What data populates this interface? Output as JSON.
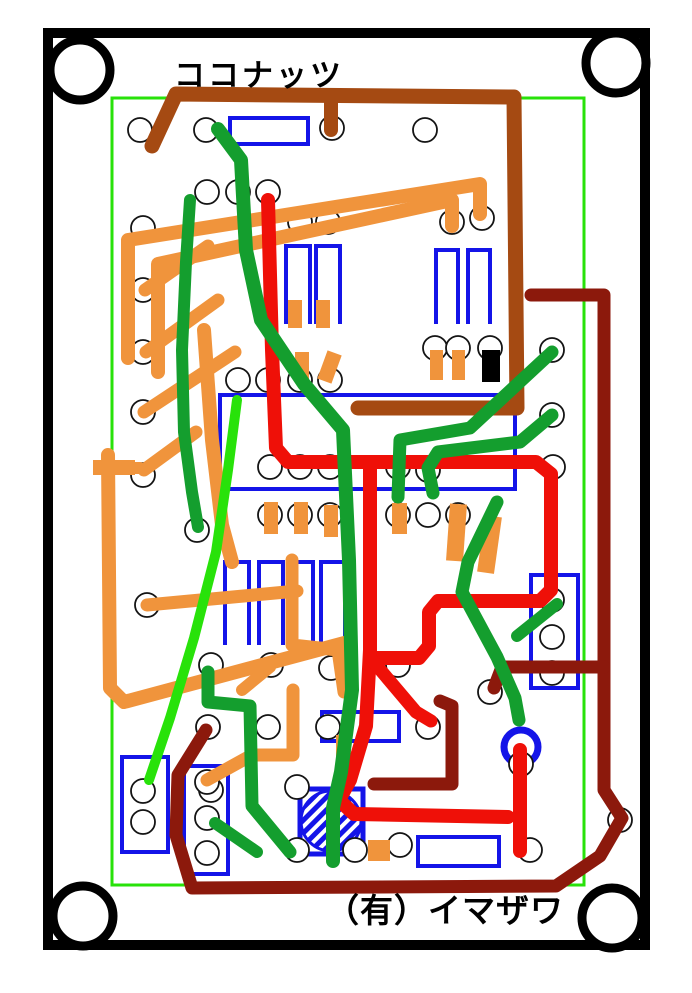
{
  "title": "ココナッツ",
  "footer": "（有）イマザワ",
  "colors": {
    "black": "#000000",
    "blue": "#1414E8",
    "orange": "#F0943C",
    "brown": "#A54A12",
    "maroon": "#8C190C",
    "red": "#EF1008",
    "green": "#149E2E",
    "bright": "#28E20A",
    "hole_stroke": "#141414",
    "white": "#ffffff"
  },
  "board": {
    "frame": {
      "x": 48,
      "y": 33,
      "w": 597,
      "h": 912,
      "stroke_w": 10
    },
    "green_border": {
      "x": 112,
      "y": 98,
      "w": 472,
      "h": 787,
      "stroke_w": 3
    },
    "corner_holes": {
      "r": 30,
      "stroke_w": 9,
      "centers": [
        [
          80,
          70
        ],
        [
          616,
          63
        ],
        [
          83,
          916
        ],
        [
          612,
          918
        ]
      ]
    },
    "hole_r": 12,
    "holes": [
      [
        140,
        130
      ],
      [
        206,
        130
      ],
      [
        332,
        128
      ],
      [
        425,
        130
      ],
      [
        207,
        192
      ],
      [
        238,
        192
      ],
      [
        268,
        192
      ],
      [
        143,
        228
      ],
      [
        300,
        222
      ],
      [
        328,
        222
      ],
      [
        452,
        222
      ],
      [
        482,
        218
      ],
      [
        143,
        290
      ],
      [
        143,
        352
      ],
      [
        143,
        412
      ],
      [
        143,
        475
      ],
      [
        238,
        380
      ],
      [
        268,
        380
      ],
      [
        300,
        380
      ],
      [
        330,
        380
      ],
      [
        435,
        348
      ],
      [
        458,
        348
      ],
      [
        490,
        348
      ],
      [
        552,
        350
      ],
      [
        552,
        415
      ],
      [
        553,
        467
      ],
      [
        270,
        467
      ],
      [
        300,
        467
      ],
      [
        330,
        467
      ],
      [
        398,
        467
      ],
      [
        428,
        470
      ],
      [
        270,
        515
      ],
      [
        300,
        515
      ],
      [
        330,
        515
      ],
      [
        398,
        515
      ],
      [
        428,
        515
      ],
      [
        458,
        515
      ],
      [
        197,
        530
      ],
      [
        147,
        605
      ],
      [
        552,
        600
      ],
      [
        552,
        637
      ],
      [
        552,
        673
      ],
      [
        398,
        665
      ],
      [
        211,
        665
      ],
      [
        271,
        665
      ],
      [
        331,
        668
      ],
      [
        208,
        727
      ],
      [
        268,
        727
      ],
      [
        328,
        727
      ],
      [
        428,
        727
      ],
      [
        490,
        692
      ],
      [
        211,
        790
      ],
      [
        143,
        791
      ],
      [
        143,
        822
      ],
      [
        207,
        782
      ],
      [
        207,
        818
      ],
      [
        207,
        853
      ],
      [
        297,
        787
      ],
      [
        297,
        850
      ],
      [
        355,
        850
      ],
      [
        400,
        845
      ],
      [
        530,
        850
      ],
      [
        620,
        820
      ],
      [
        521,
        764
      ]
    ],
    "components": [
      [
        230,
        118,
        78,
        26
      ],
      [
        220,
        395,
        295,
        94
      ],
      [
        531,
        575,
        47,
        113
      ],
      [
        122,
        757,
        46,
        95
      ],
      [
        184,
        766,
        44,
        108
      ],
      [
        418,
        837,
        81,
        29
      ],
      [
        322,
        712,
        77,
        29
      ]
    ],
    "pin_loops": [
      [
        286,
        246,
        310,
        324
      ],
      [
        316,
        246,
        340,
        324
      ],
      [
        436,
        250,
        458,
        324
      ],
      [
        468,
        250,
        490,
        324
      ],
      [
        225,
        562,
        249,
        645
      ],
      [
        259,
        562,
        283,
        645
      ],
      [
        289,
        562,
        313,
        645
      ],
      [
        321,
        562,
        345,
        645
      ]
    ],
    "transistor": {
      "x": 300,
      "y": 789,
      "w": 63,
      "h": 65,
      "cx": 331,
      "cy": 821,
      "r": 30
    },
    "ring": {
      "cx": 521,
      "cy": 747,
      "r": 17,
      "stroke_w": 7
    },
    "black_pad": [
      482,
      350,
      18,
      32
    ],
    "pads": [
      [
        430,
        350,
        13,
        30,
        0
      ],
      [
        452,
        350,
        13,
        30,
        0
      ],
      [
        295,
        352,
        14,
        30,
        0
      ],
      [
        322,
        352,
        15,
        30,
        20
      ],
      [
        288,
        300,
        14,
        28,
        0
      ],
      [
        316,
        300,
        14,
        28,
        0
      ],
      [
        264,
        502,
        14,
        32,
        0
      ],
      [
        294,
        502,
        14,
        32,
        0
      ],
      [
        324,
        505,
        14,
        32,
        0
      ],
      [
        392,
        503,
        15,
        31,
        0
      ],
      [
        448,
        504,
        17,
        57,
        4
      ],
      [
        481,
        516,
        17,
        57,
        8
      ],
      [
        93,
        460,
        42,
        15,
        0
      ],
      [
        336,
        735,
        15,
        27,
        0
      ],
      [
        368,
        840,
        22,
        21,
        0
      ]
    ],
    "wires": [
      {
        "c": "orange",
        "w": 14,
        "p": [
          [
            128,
            358
          ],
          [
            128,
            240
          ],
          [
            480,
            184
          ],
          [
            480,
            214
          ]
        ]
      },
      {
        "c": "orange",
        "w": 14,
        "p": [
          [
            158,
            372
          ],
          [
            158,
            264
          ],
          [
            452,
            200
          ],
          [
            452,
            226
          ]
        ]
      },
      {
        "c": "orange",
        "w": 13,
        "p": [
          [
            145,
            290
          ],
          [
            208,
            246
          ]
        ]
      },
      {
        "c": "orange",
        "w": 13,
        "p": [
          [
            146,
            352
          ],
          [
            218,
            300
          ]
        ]
      },
      {
        "c": "orange",
        "w": 13,
        "p": [
          [
            144,
            412
          ],
          [
            235,
            352
          ]
        ]
      },
      {
        "c": "orange",
        "w": 13,
        "p": [
          [
            144,
            470
          ],
          [
            196,
            432
          ]
        ]
      },
      {
        "c": "orange",
        "w": 14,
        "p": [
          [
            204,
            330
          ],
          [
            212,
            440
          ],
          [
            222,
            525
          ],
          [
            232,
            562
          ]
        ]
      },
      {
        "c": "orange",
        "w": 13,
        "p": [
          [
            147,
            605
          ],
          [
            297,
            591
          ]
        ]
      },
      {
        "c": "orange",
        "w": 13,
        "p": [
          [
            292,
            560
          ],
          [
            292,
            645
          ],
          [
            338,
            650
          ],
          [
            344,
            692
          ]
        ]
      },
      {
        "c": "orange",
        "w": 14,
        "p": [
          [
            108,
            455
          ],
          [
            110,
            688
          ],
          [
            124,
            702
          ],
          [
            348,
            642
          ]
        ]
      },
      {
        "c": "orange",
        "w": 13,
        "p": [
          [
            207,
            780
          ],
          [
            252,
            755
          ],
          [
            293,
            755
          ],
          [
            293,
            690
          ]
        ]
      },
      {
        "c": "orange",
        "w": 12,
        "p": [
          [
            242,
            690
          ],
          [
            270,
            667
          ]
        ]
      },
      {
        "c": "orange",
        "w": 12,
        "p": [
          [
            100,
            468
          ],
          [
            140,
            468
          ]
        ]
      },
      {
        "c": "brown",
        "w": 15,
        "p": [
          [
            152,
            146
          ],
          [
            176,
            94
          ],
          [
            514,
            97
          ],
          [
            517,
            408
          ],
          [
            358,
            408
          ]
        ]
      },
      {
        "c": "brown",
        "w": 14,
        "p": [
          [
            331,
            102
          ],
          [
            331,
            130
          ]
        ]
      },
      {
        "c": "maroon",
        "w": 13,
        "p": [
          [
            531,
            295
          ],
          [
            604,
            295
          ],
          [
            604,
            790
          ],
          [
            622,
            818
          ],
          [
            600,
            856
          ],
          [
            556,
            886
          ],
          [
            192,
            888
          ],
          [
            176,
            835
          ],
          [
            178,
            775
          ],
          [
            206,
            730
          ]
        ]
      },
      {
        "c": "maroon",
        "w": 13,
        "p": [
          [
            604,
            667
          ],
          [
            502,
            667
          ],
          [
            494,
            688
          ]
        ]
      },
      {
        "c": "maroon",
        "w": 13,
        "p": [
          [
            374,
            784
          ],
          [
            452,
            784
          ],
          [
            452,
            706
          ],
          [
            440,
            701
          ]
        ]
      },
      {
        "c": "red",
        "w": 14,
        "p": [
          [
            268,
            200
          ],
          [
            272,
            350
          ],
          [
            276,
            448
          ],
          [
            288,
            462
          ],
          [
            536,
            462
          ],
          [
            551,
            474
          ],
          [
            551,
            590
          ],
          [
            540,
            601
          ],
          [
            438,
            601
          ],
          [
            429,
            612
          ],
          [
            429,
            646
          ],
          [
            419,
            658
          ],
          [
            370,
            658
          ]
        ]
      },
      {
        "c": "red",
        "w": 14,
        "p": [
          [
            370,
            462
          ],
          [
            370,
            650
          ],
          [
            366,
            726
          ],
          [
            350,
            780
          ],
          [
            339,
            800
          ],
          [
            354,
            814
          ],
          [
            508,
            817
          ]
        ]
      },
      {
        "c": "red",
        "w": 14,
        "p": [
          [
            520,
            750
          ],
          [
            520,
            851
          ]
        ]
      },
      {
        "c": "red",
        "w": 13,
        "p": [
          [
            372,
            660
          ],
          [
            416,
            712
          ],
          [
            431,
            721
          ]
        ]
      },
      {
        "c": "green",
        "w": 14,
        "p": [
          [
            218,
            129
          ],
          [
            241,
            160
          ],
          [
            246,
            250
          ],
          [
            261,
            320
          ],
          [
            304,
            384
          ],
          [
            343,
            430
          ],
          [
            349,
            560
          ],
          [
            352,
            690
          ],
          [
            341,
            772
          ],
          [
            333,
            808
          ],
          [
            333,
            861
          ]
        ]
      },
      {
        "c": "green",
        "w": 12,
        "p": [
          [
            190,
            200
          ],
          [
            186,
            262
          ],
          [
            182,
            350
          ],
          [
            184,
            432
          ],
          [
            192,
            492
          ],
          [
            198,
            527
          ]
        ]
      },
      {
        "c": "green",
        "w": 13,
        "p": [
          [
            552,
            352
          ],
          [
            470,
            428
          ],
          [
            400,
            440
          ],
          [
            398,
            497
          ]
        ]
      },
      {
        "c": "green",
        "w": 13,
        "p": [
          [
            552,
            415
          ],
          [
            520,
            442
          ],
          [
            438,
            452
          ],
          [
            428,
            468
          ],
          [
            433,
            493
          ]
        ]
      },
      {
        "c": "green",
        "w": 13,
        "p": [
          [
            497,
            502
          ],
          [
            468,
            562
          ],
          [
            462,
            592
          ],
          [
            497,
            657
          ],
          [
            515,
            698
          ],
          [
            519,
            720
          ]
        ]
      },
      {
        "c": "green",
        "w": 12,
        "p": [
          [
            557,
            604
          ],
          [
            517,
            636
          ]
        ]
      },
      {
        "c": "green",
        "w": 13,
        "p": [
          [
            208,
            672
          ],
          [
            208,
            702
          ],
          [
            250,
            706
          ],
          [
            252,
            806
          ],
          [
            290,
            852
          ]
        ]
      },
      {
        "c": "green",
        "w": 12,
        "p": [
          [
            215,
            823
          ],
          [
            257,
            852
          ]
        ]
      },
      {
        "c": "bright",
        "w": 10,
        "p": [
          [
            237,
            400
          ],
          [
            228,
            470
          ],
          [
            216,
            552
          ],
          [
            194,
            638
          ],
          [
            170,
            718
          ],
          [
            149,
            780
          ]
        ]
      }
    ]
  }
}
